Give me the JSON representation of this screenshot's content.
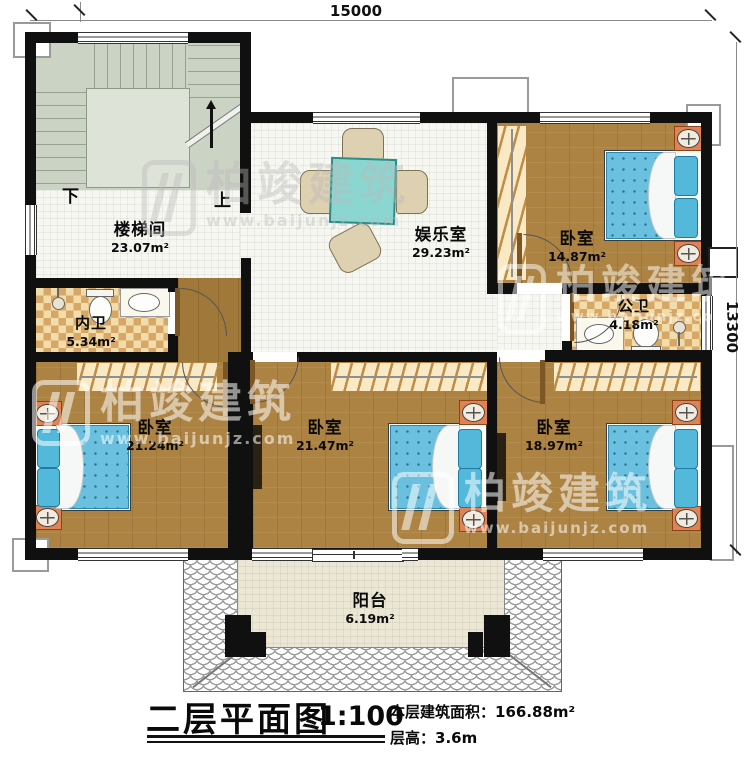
{
  "plan": {
    "dimension_top": "15000",
    "dimension_right": "13300",
    "stairs": {
      "down": "下",
      "up": "上"
    },
    "rooms": [
      {
        "id": "stairwell",
        "name": "楼梯间",
        "area": "23.07m²"
      },
      {
        "id": "entertainment",
        "name": "娱乐室",
        "area": "29.23m²"
      },
      {
        "id": "bedroom-ne",
        "name": "卧室",
        "area": "14.87m²"
      },
      {
        "id": "bath-inner",
        "name": "内卫",
        "area": "5.34m²"
      },
      {
        "id": "bath-public",
        "name": "公卫",
        "area": "4.18m²"
      },
      {
        "id": "bedroom-sw",
        "name": "卧室",
        "area": "21.24m²"
      },
      {
        "id": "bedroom-s",
        "name": "卧室",
        "area": "21.47m²"
      },
      {
        "id": "bedroom-se",
        "name": "卧室",
        "area": "18.97m²"
      },
      {
        "id": "balcony",
        "name": "阳台",
        "area": "6.19m²"
      }
    ],
    "watermark": {
      "brand": "柏竣建筑",
      "site": "www.baijunjz.com"
    },
    "palette": {
      "wall": "#101010",
      "wood_floor": "#ad8343",
      "tile": "#d7a768",
      "stair": "#cbd3c5",
      "mattress": "#6ac0de",
      "table": "#8bd6d0",
      "wardrobe": "#f9e9c4"
    }
  },
  "titleblock": {
    "title": "二层平面图",
    "scale": "1:100",
    "area_label": "本层建筑面积：",
    "area_value": "166.88m²",
    "height_label": "层高：",
    "height_value": "3.6m"
  }
}
